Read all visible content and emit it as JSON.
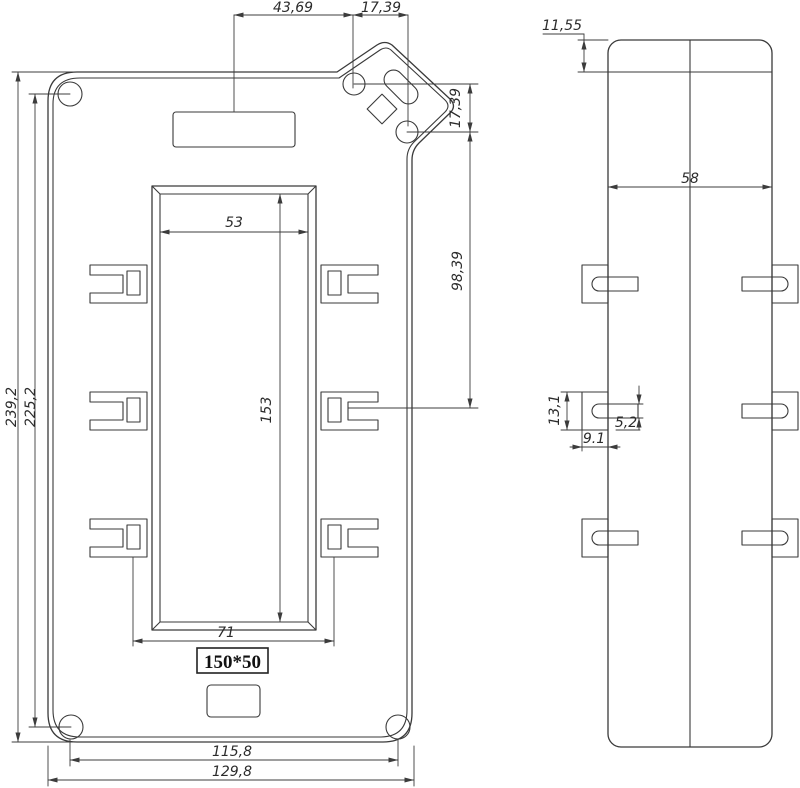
{
  "drawing": {
    "front_view": {
      "size_label": "150*50",
      "dims": {
        "top_span_left": "43,69",
        "top_span_right": "17,39",
        "tab_hole_offset": "17,39",
        "tab_to_middle_clip": "98,39",
        "overall_height": "239,2",
        "hole_span_height": "225,2",
        "opening_width": "53",
        "opening_height": "153",
        "clip_slot_span": "71",
        "hole_span_width": "115,8",
        "overall_width": "129,8"
      }
    },
    "side_view": {
      "dims": {
        "top_band_height": "11,55",
        "depth": "58",
        "clip_height": "13,1",
        "slot_height": "5,2",
        "clip_depth": "9.1"
      }
    }
  }
}
